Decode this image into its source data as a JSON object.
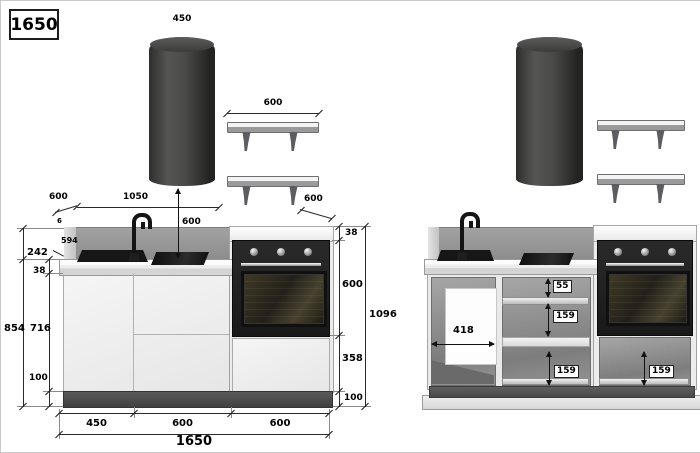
{
  "page": {
    "title_box": "1650"
  },
  "left_view": {
    "hood_width": "450",
    "shelf_width": "600",
    "shelf_depth": "600",
    "counter_depth_diag": "600",
    "run_width": "1050",
    "hood_clearance": "600",
    "splash_thickness": "6",
    "counter_depth": "594",
    "splash_height": "242",
    "counter_thickness": "38",
    "side_height": "854",
    "front_height": "716",
    "plinth_left": "100",
    "top_panel": "38",
    "oven_height": "600",
    "drawer_height": "358",
    "plinth_right": "100",
    "total_height": "1096",
    "seg1": "450",
    "seg2": "600",
    "seg3": "600",
    "total_width": "1650"
  },
  "right_view": {
    "opening_width": "418",
    "top_gap": "55",
    "shelf_gap": "159",
    "bottom_gap_mid": "159",
    "bottom_gap_oven": "159"
  }
}
